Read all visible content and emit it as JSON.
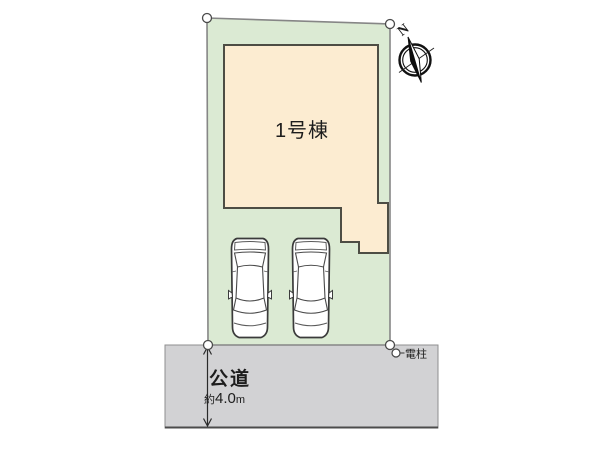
{
  "site_plan": {
    "building": {
      "label": "1号棟"
    },
    "road": {
      "name": "公道",
      "width_prefix": "約",
      "width_value": "4.0",
      "width_unit": "m"
    },
    "utility_pole": {
      "label": "電柱"
    },
    "compass": {
      "north": "N"
    },
    "parking": {
      "car_count": 2
    },
    "colors": {
      "plot_fill": "#dbead3",
      "building_fill": "#fcecd1",
      "road_fill": "#d2d2d4",
      "car_fill": "#ffffff"
    }
  }
}
